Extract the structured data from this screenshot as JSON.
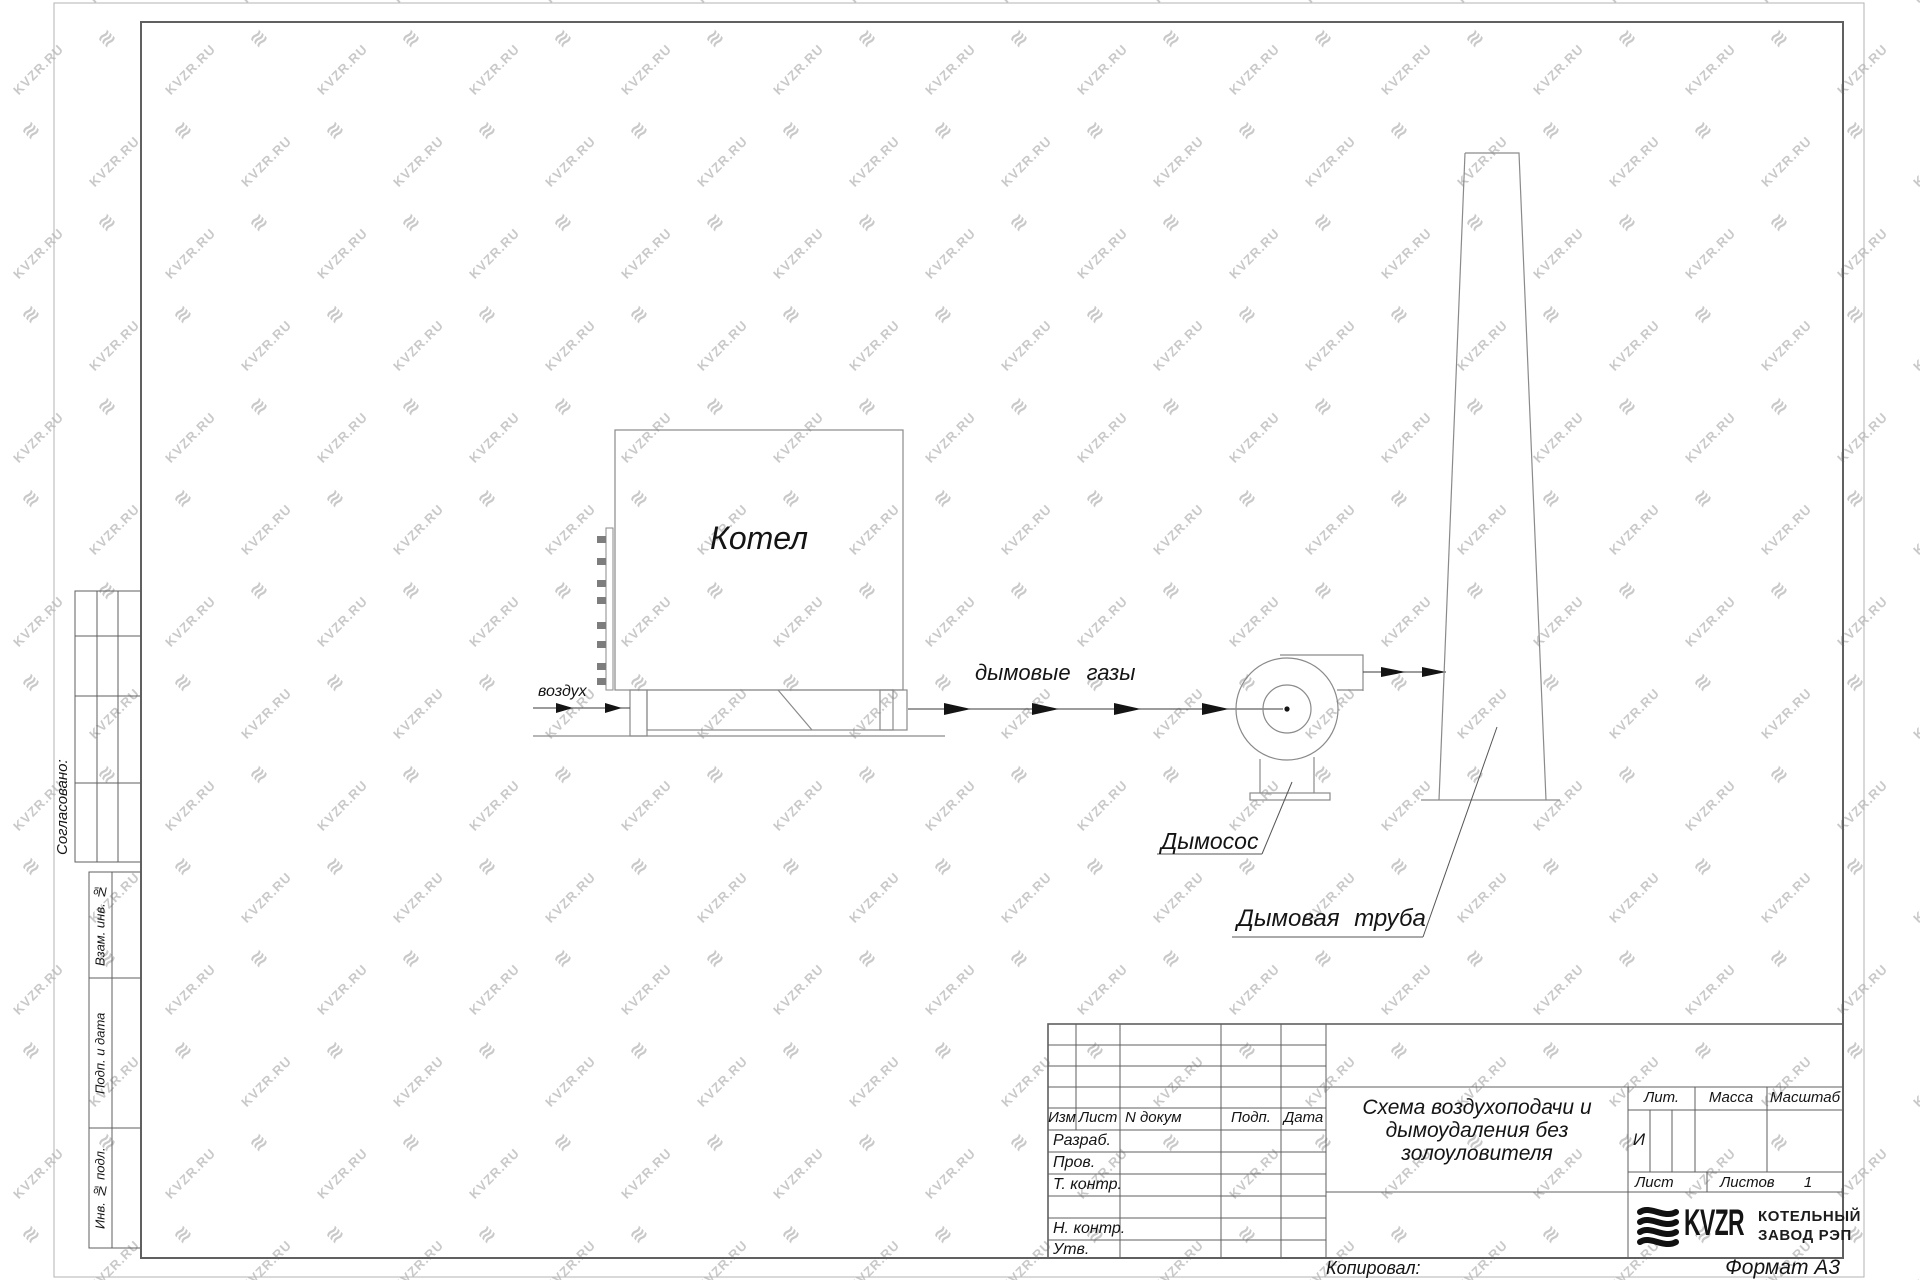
{
  "colors": {
    "ink": "#141414",
    "line": "#8a8a8a",
    "frame": "#5f5f5f",
    "wm": "#c9c9c9"
  },
  "watermark": {
    "text": "KVZR.RU"
  },
  "drawing": {
    "boiler_label": "Котел",
    "air_label": "воздух",
    "flue_gas_label": "дымовые газы",
    "fan_label": "Дымосос",
    "chimney_label": "Дымовая труба"
  },
  "side_panel": {
    "approved_label": "Согласовано:",
    "strip_labels": [
      "Взам. инв. №",
      "Подп. и дата",
      "Инв. № подл."
    ]
  },
  "title_block": {
    "header_cols": [
      "Изм",
      "Лист",
      "N докум",
      "Подп.",
      "Дата"
    ],
    "sign_rows": [
      "Разраб.",
      "Пров.",
      "Т. контр.",
      "Н. контр.",
      "Утв."
    ],
    "title_lines": [
      "Схема воздухоподачи и",
      "дымоудаления без",
      "золоуловителя"
    ],
    "lit_label": "Лит.",
    "mass_label": "Масса",
    "scale_label": "Масштаб",
    "lit_value": "И",
    "sheet_label": "Лист",
    "sheets_label": "Листов",
    "sheets_value": "1",
    "logo_text": "KVZR",
    "org_line1": "КОТЕЛЬНЫЙ",
    "org_line2": "ЗАВОД РЭП"
  },
  "footer": {
    "copied_label": "Копировал:",
    "format_label": "Формат А3"
  }
}
